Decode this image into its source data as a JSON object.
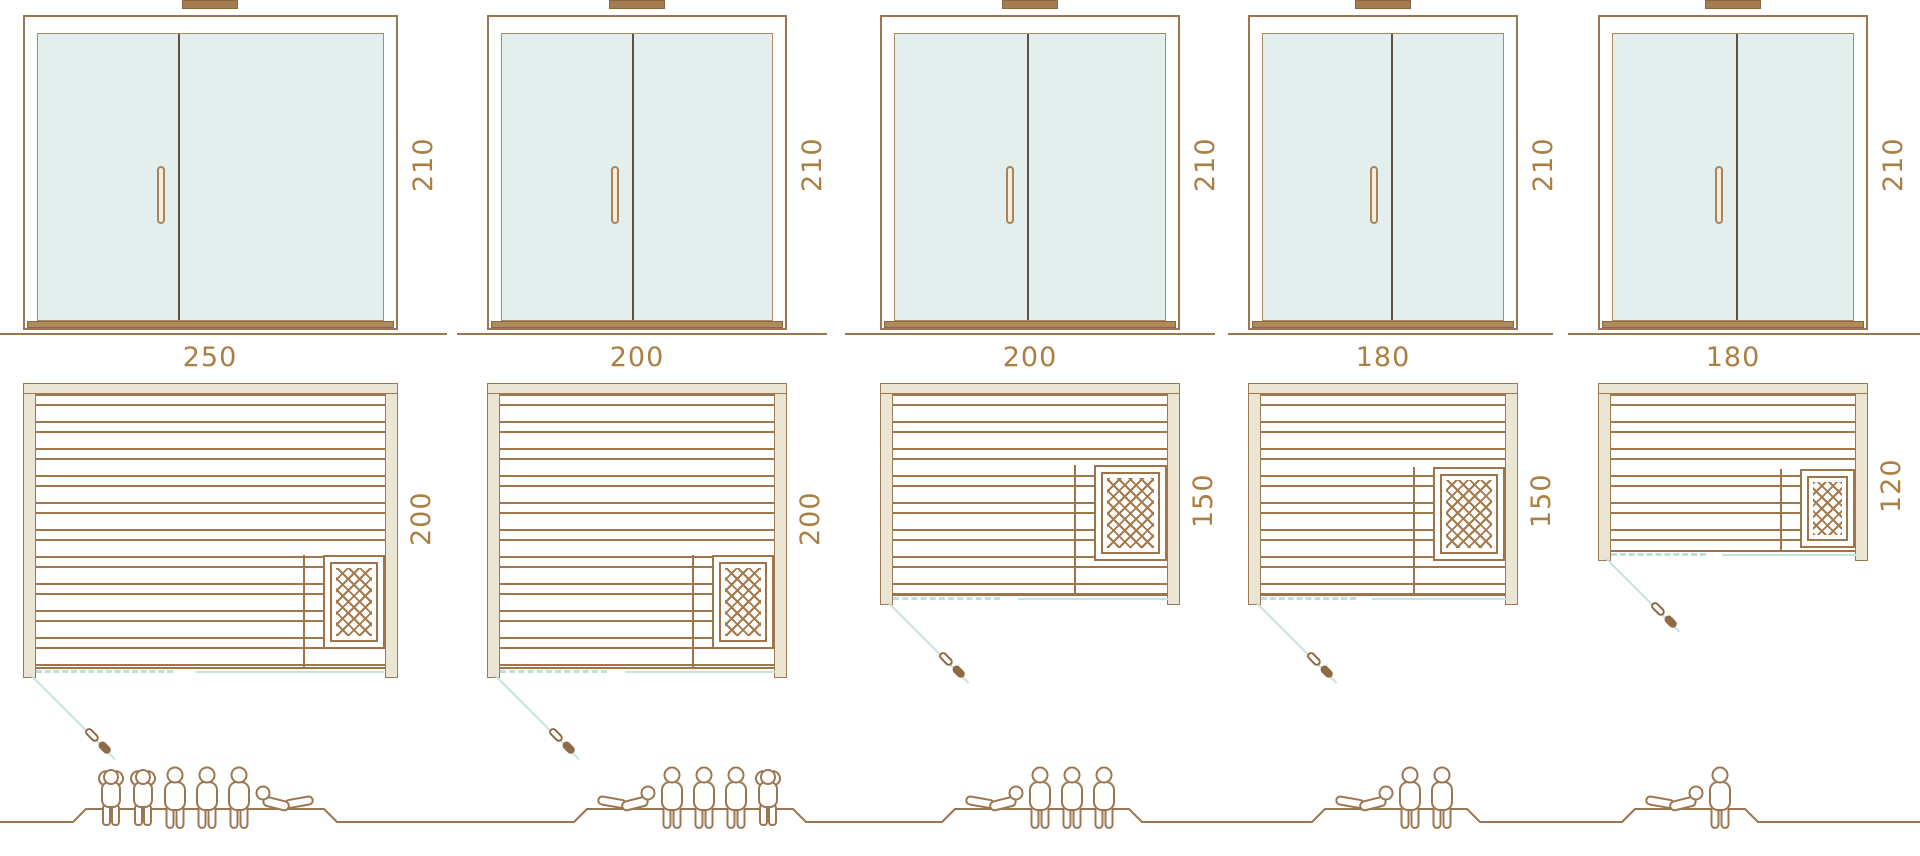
{
  "diagram": {
    "name": "Sauna size comparison diagram",
    "views": [
      "front elevation",
      "floor plan",
      "capacity figures"
    ]
  },
  "colors": {
    "line_brown": "#9b7650",
    "label_brown": "#ab7f41",
    "wall_beige": "#eae6d3",
    "glass_blue": "#e2efec",
    "swing_blue": "#c6e2dd",
    "divider_dark": "#5a5244"
  },
  "saunas": [
    {
      "width": "250",
      "height": "210",
      "depth": "200",
      "persons": 6,
      "people": [
        "standing",
        "standing",
        "sitting",
        "sitting",
        "sitting",
        "lying-head-left"
      ]
    },
    {
      "width": "200",
      "height": "210",
      "depth": "200",
      "persons": 5,
      "people": [
        "lying-head-right",
        "sitting",
        "sitting",
        "sitting",
        "standing"
      ]
    },
    {
      "width": "200",
      "height": "210",
      "depth": "150",
      "persons": 4,
      "people": [
        "lying-head-right",
        "sitting",
        "sitting",
        "sitting"
      ]
    },
    {
      "width": "180",
      "height": "210",
      "depth": "150",
      "persons": 3,
      "people": [
        "lying-head-right",
        "sitting",
        "sitting"
      ]
    },
    {
      "width": "180",
      "height": "210",
      "depth": "120",
      "persons": 2,
      "people": [
        "lying-head-right",
        "sitting"
      ]
    }
  ]
}
